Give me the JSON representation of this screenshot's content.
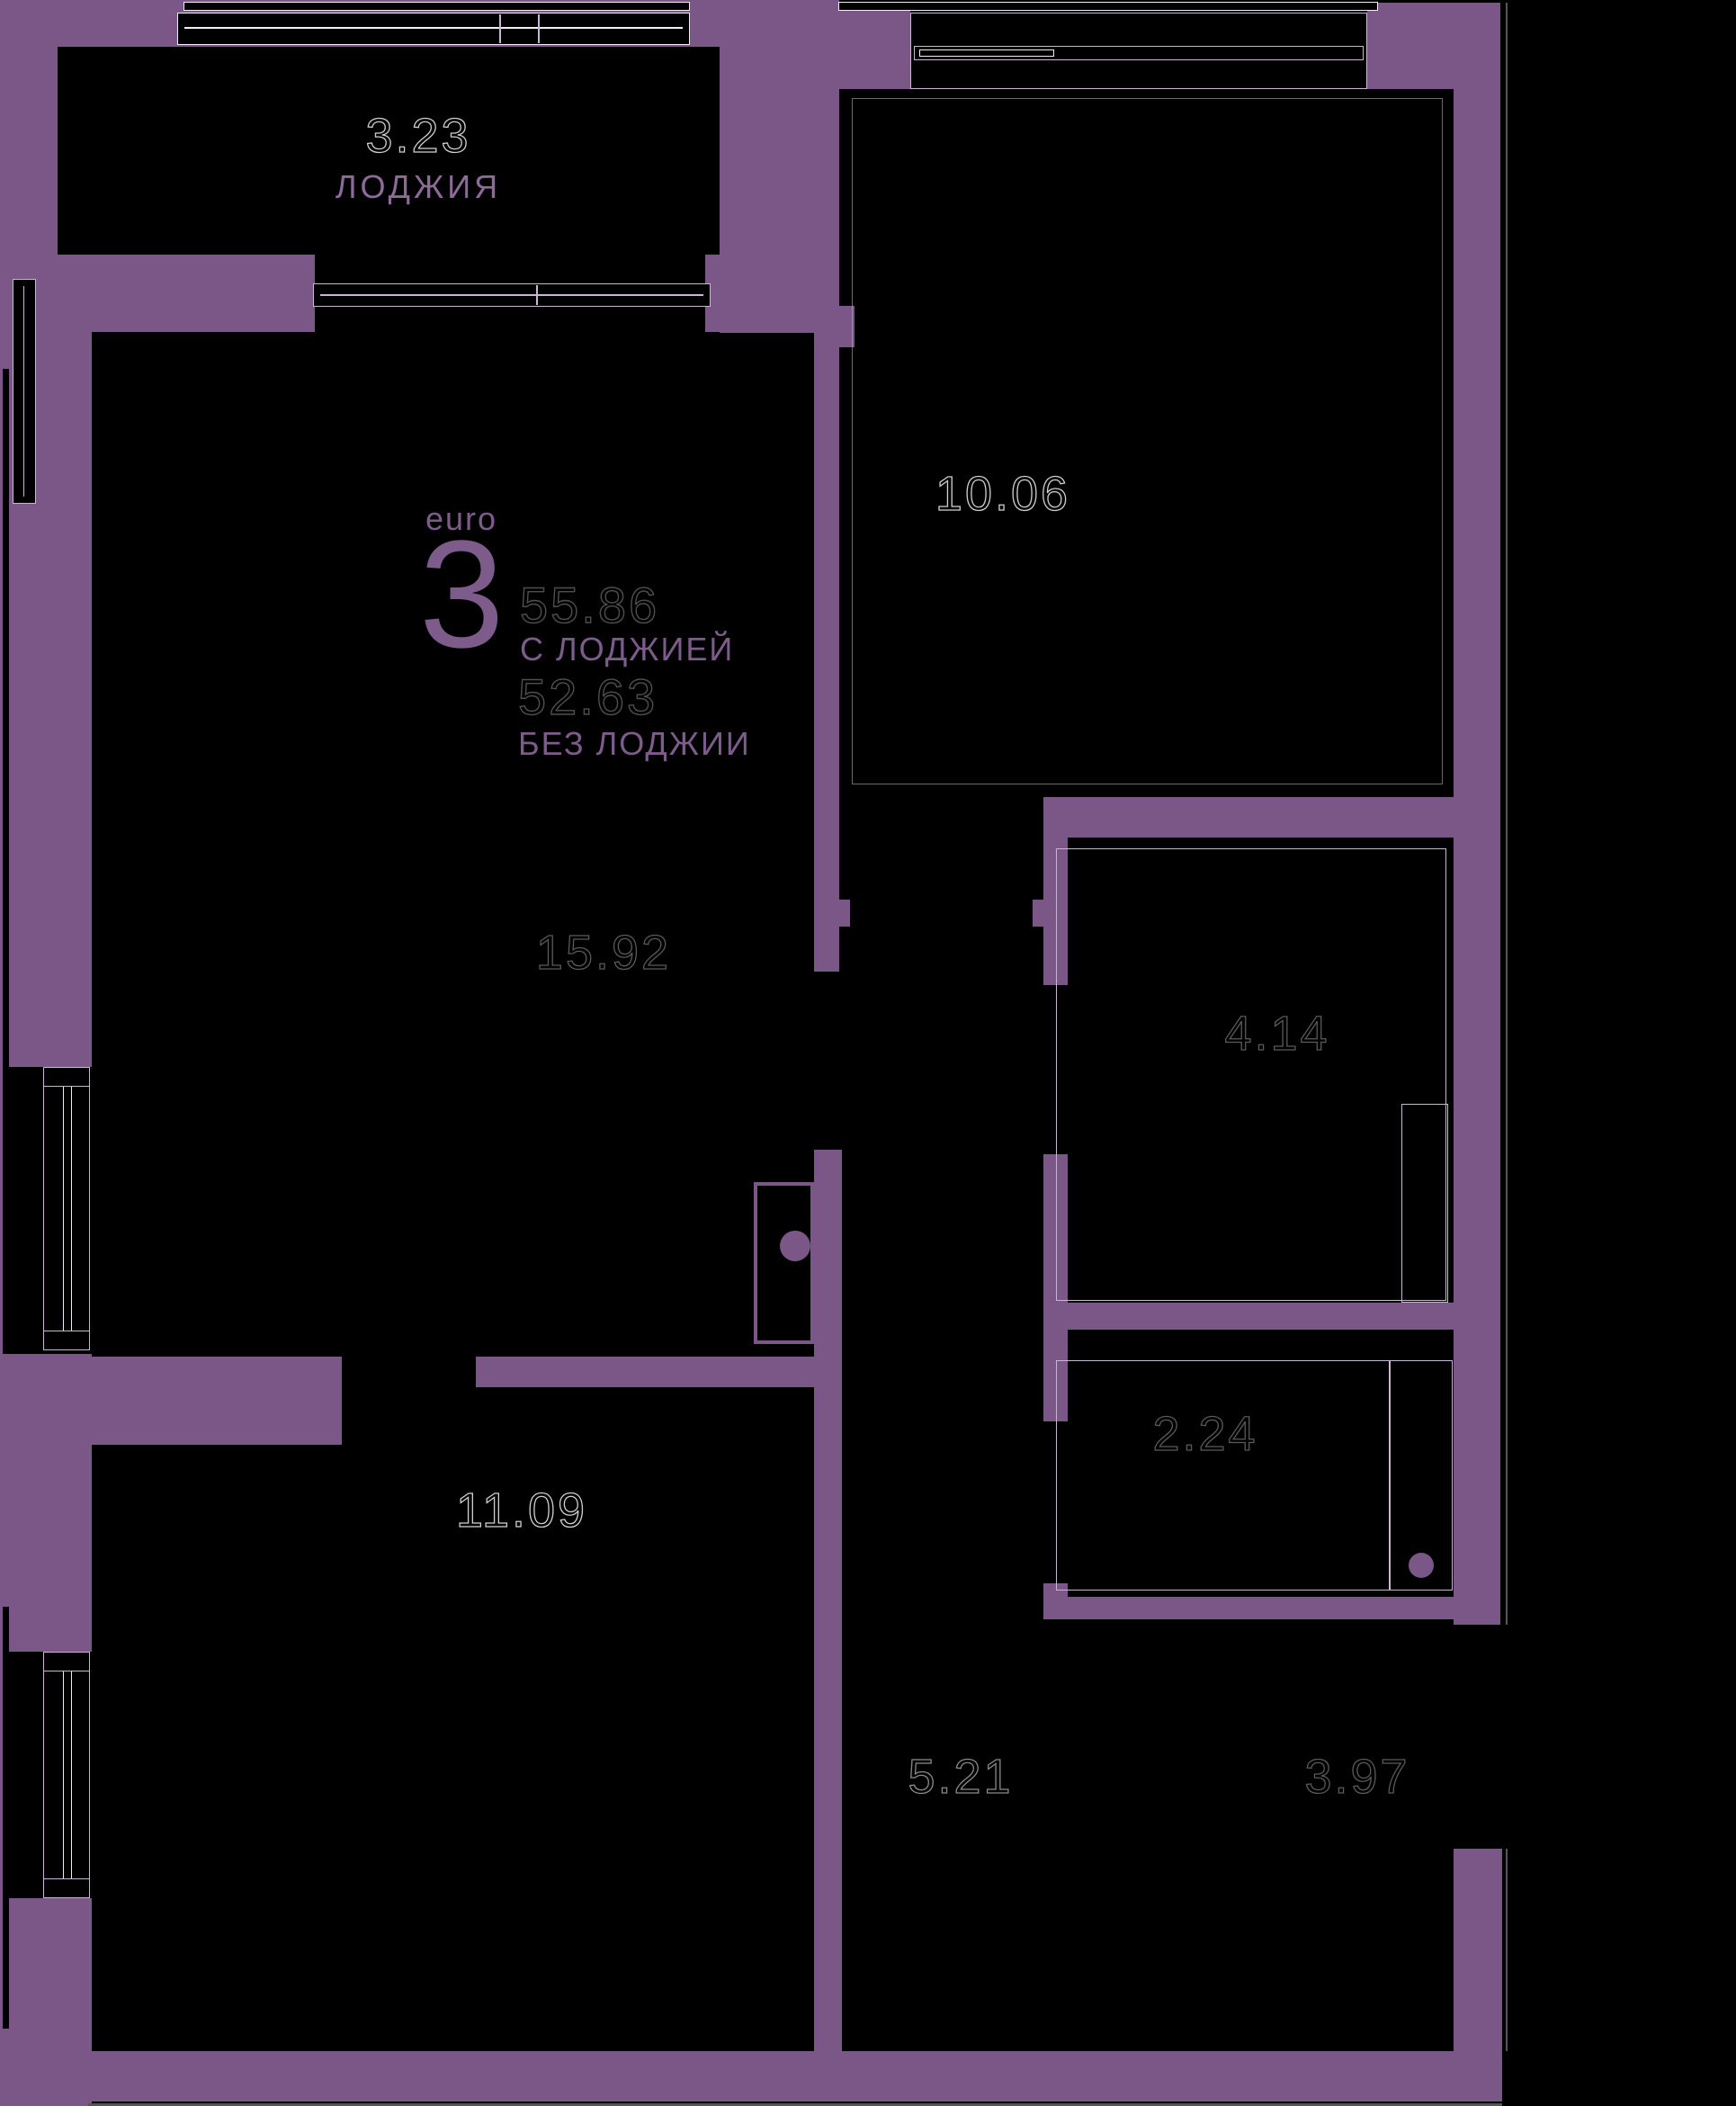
{
  "plan": {
    "title": {
      "type_label": "euro",
      "rooms_count": "3",
      "area_with": "55.86",
      "with_label": "С ЛОДЖИЕЙ",
      "area_without": "52.63",
      "without_label": "БЕЗ ЛОДЖИИ"
    },
    "rooms": [
      {
        "id": "loggia",
        "area": "3.23",
        "name": "ЛОДЖИЯ"
      },
      {
        "id": "living",
        "area": "15.92",
        "name": ""
      },
      {
        "id": "bedroom",
        "area": "10.06",
        "name": ""
      },
      {
        "id": "bathroom",
        "area": "4.14",
        "name": ""
      },
      {
        "id": "wc",
        "area": "2.24",
        "name": ""
      },
      {
        "id": "room2",
        "area": "11.09",
        "name": ""
      },
      {
        "id": "hall",
        "area": "5.21",
        "name": ""
      },
      {
        "id": "entry",
        "area": "3.97",
        "name": ""
      }
    ],
    "colors": {
      "background": "#000000",
      "wall": "#7a5786",
      "outline": "#c9b6d4",
      "glass": "#f2ecf7",
      "accent": "#7d5b8a",
      "loggia_label": "#8d6a99",
      "label_bright": "#cfcfcf",
      "label_mid": "#8a8a8a",
      "label_dim": "#5a5a5a",
      "title_num": "#4f4f4f"
    }
  }
}
